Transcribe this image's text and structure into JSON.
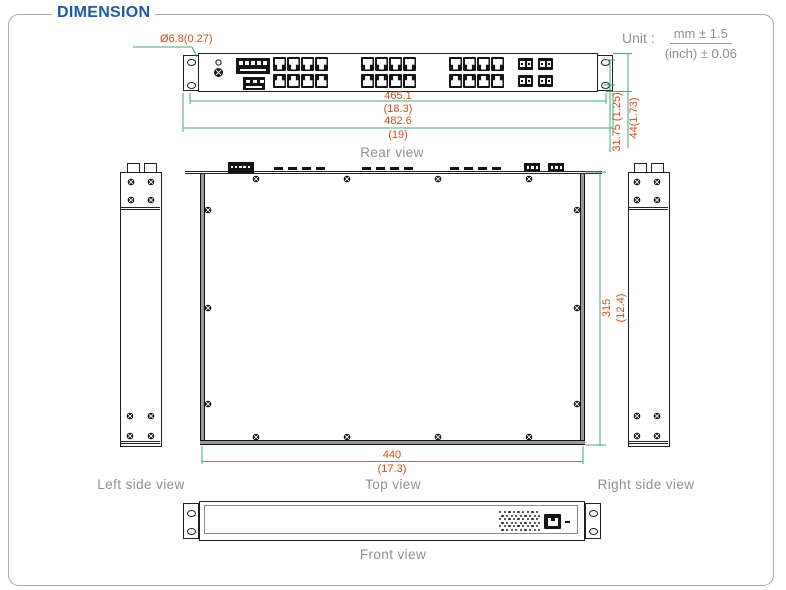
{
  "section_title": "DIMENSION",
  "unit": {
    "label": "Unit :",
    "tolerance_mm": "mm ± 1.5",
    "tolerance_inch": "(inch) ± 0.06"
  },
  "views": {
    "rear": {
      "label": "Rear view"
    },
    "top": {
      "label": "Top view"
    },
    "left_side": {
      "label": "Left side view"
    },
    "right_side": {
      "label": "Right side view"
    },
    "front": {
      "label": "Front view"
    }
  },
  "dimensions": {
    "mounting_hole_diameter": "Ø6.8(0.27)",
    "rear_inner_width_mm": "465.1",
    "rear_inner_width_inch": "(18.3)",
    "rear_outer_width_mm": "482.6",
    "rear_outer_width_inch": "(19)",
    "ear_hole_pitch": "31.75 (1.25)",
    "height": "44(1.73)",
    "body_width_mm": "440",
    "body_width_inch": "(17.3)",
    "depth_mm": "315",
    "depth_inch": "(12.4)"
  },
  "colors": {
    "accent_blue": "#1b5aa9",
    "dimension_text": "#cc4e1d",
    "dimension_line": "#46a478",
    "label_gray": "#8f8f8f"
  }
}
